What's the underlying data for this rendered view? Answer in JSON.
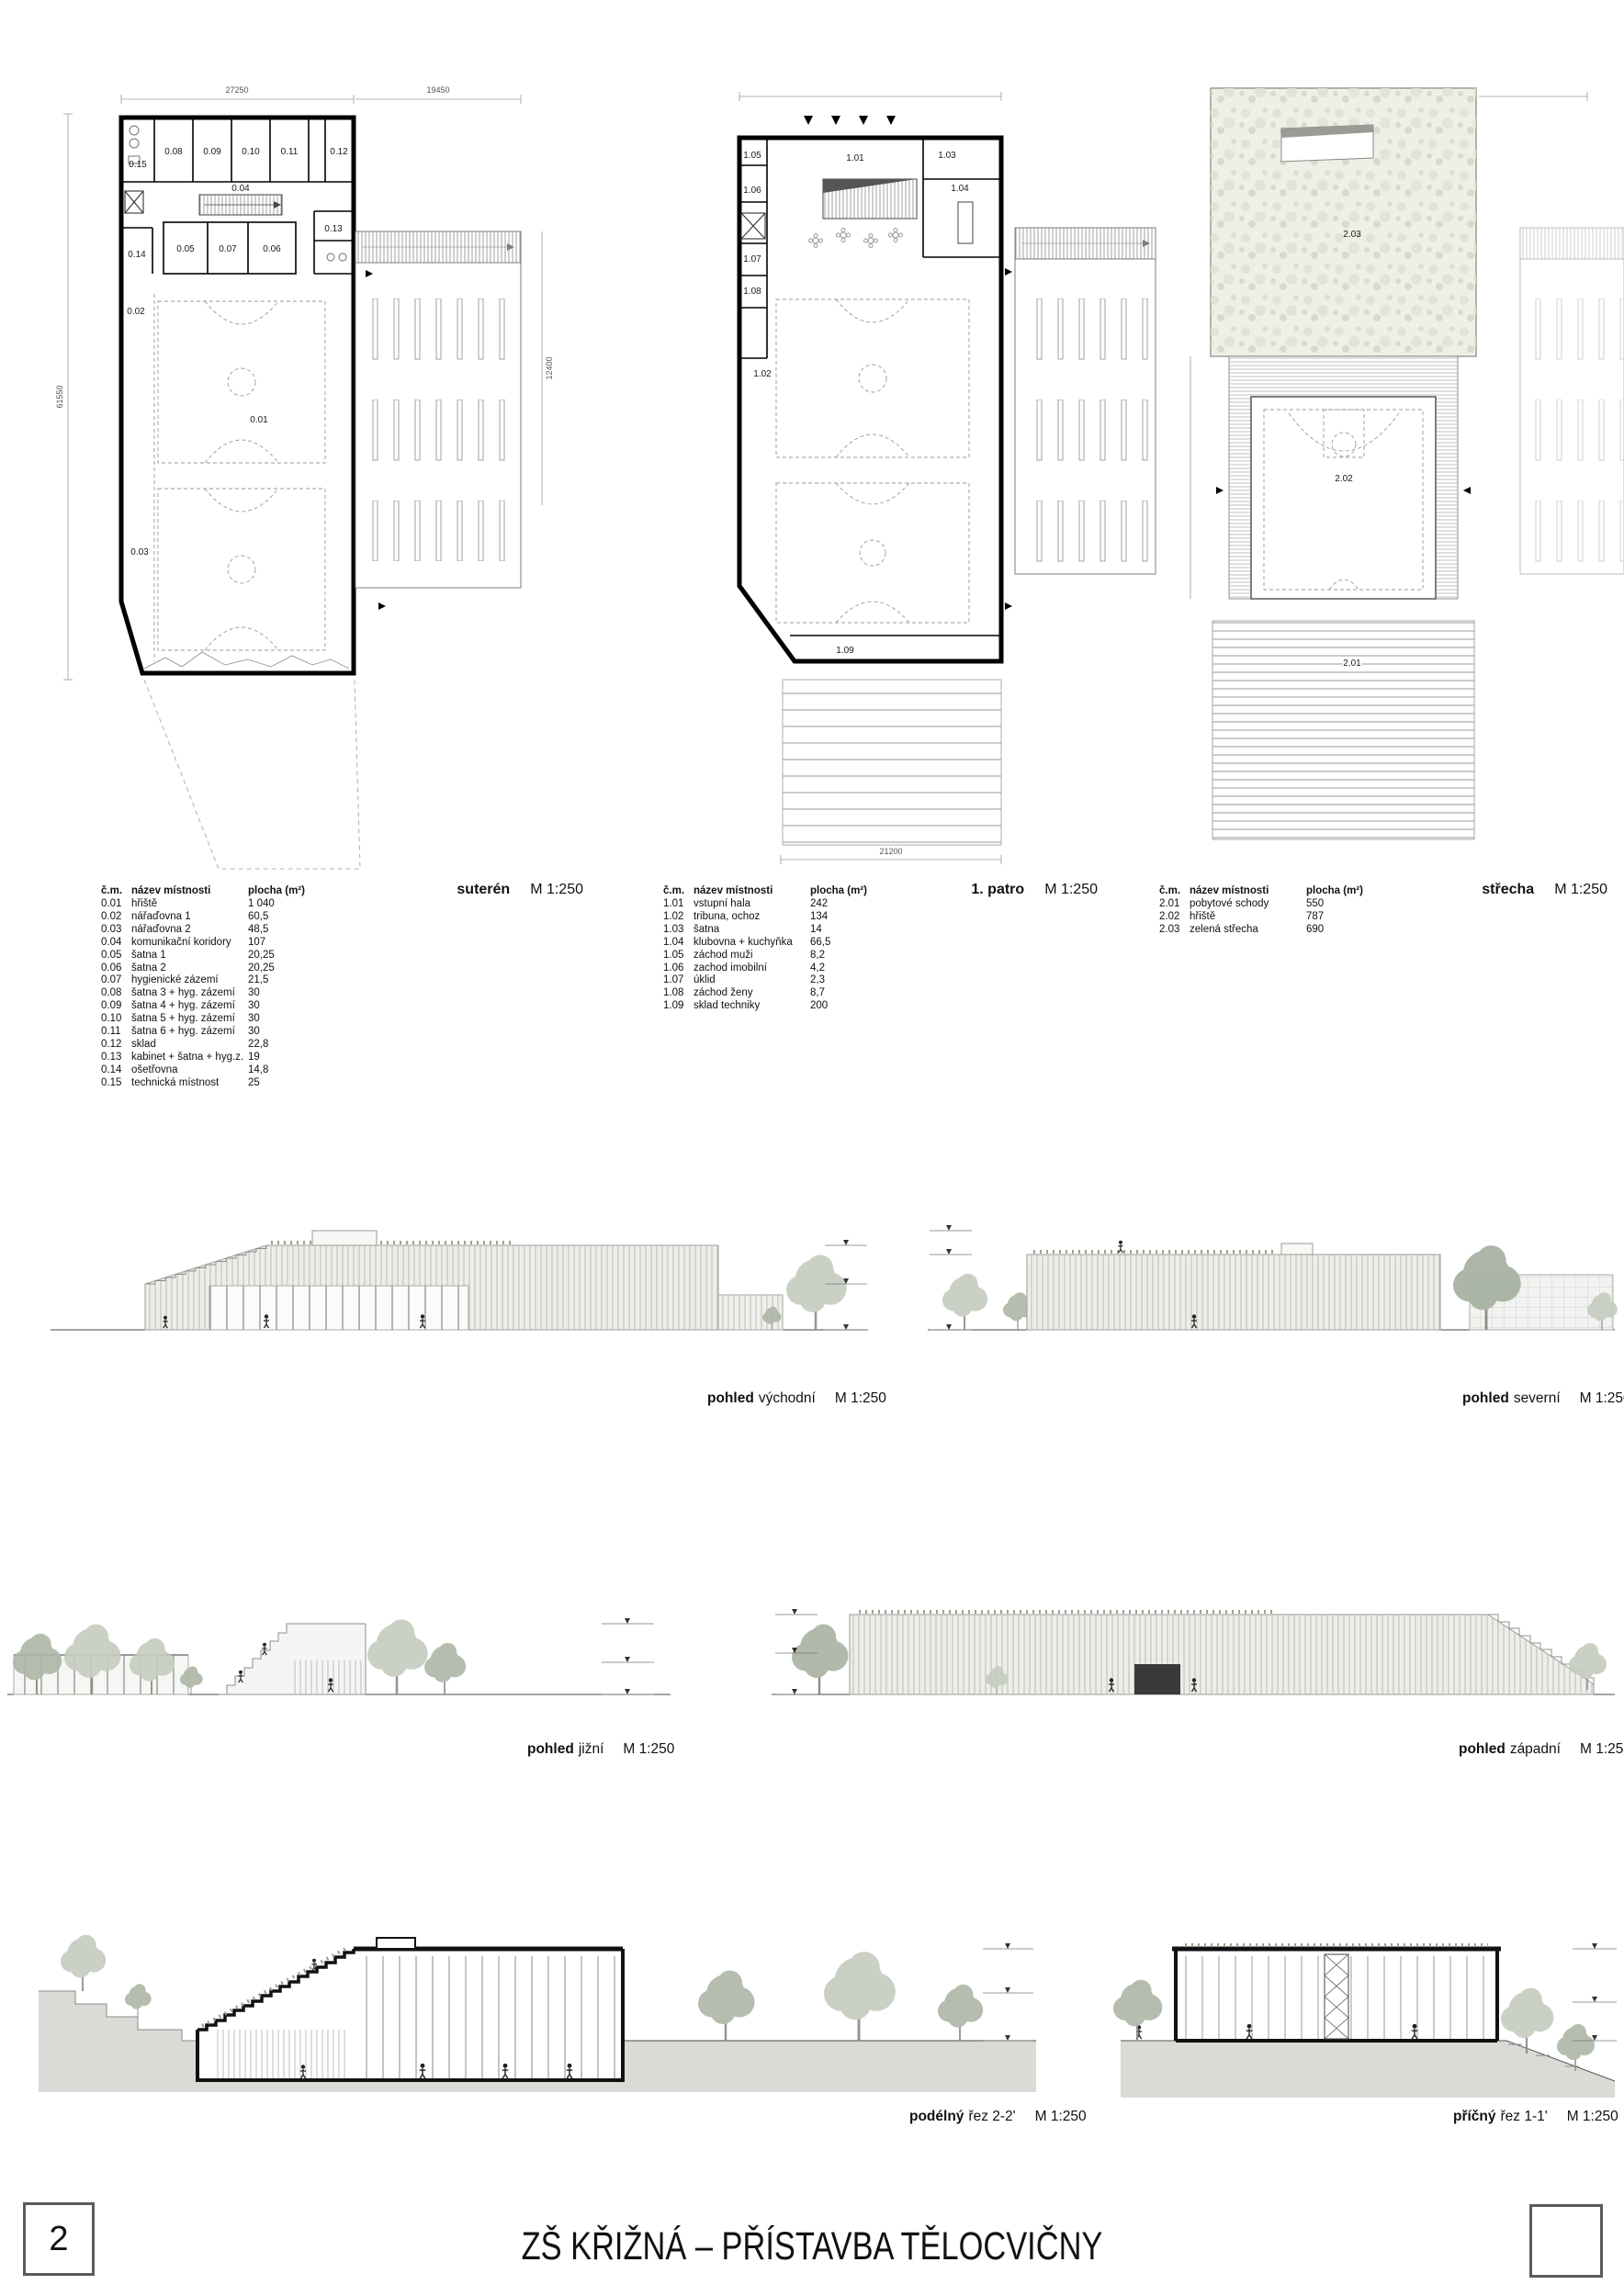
{
  "sheet": {
    "page_number": "2",
    "title": "ZŠ KŘIŽNÁ – PŘÍSTAVBA TĚLOCVIČNY"
  },
  "legend_columns": [
    "č.m.",
    "název místnosti",
    "plocha (m²)"
  ],
  "plans": {
    "suteren": {
      "caption": "suterén",
      "scale": "M 1:250",
      "dims": {
        "top_left": "27250",
        "top_right": "19450",
        "left": "61550",
        "right": "12400"
      },
      "rooms": [
        "0.15",
        "0.08",
        "0.09",
        "0.10",
        "0.11",
        "0.12",
        "0.04",
        "0.05",
        "0.07",
        "0.06",
        "0.13",
        "0.14",
        "0.02",
        "0.01",
        "0.03"
      ]
    },
    "patro": {
      "caption": "1. patro",
      "scale": "M 1:250",
      "dims": {
        "bottom": "21200"
      },
      "rooms": [
        "1.05",
        "1.06",
        "1.07",
        "1.08",
        "1.01",
        "1.03",
        "1.04",
        "1.02",
        "1.09"
      ]
    },
    "strecha": {
      "caption": "střecha",
      "scale": "M 1:250",
      "rooms": [
        "2.03",
        "2.02",
        "2.01"
      ]
    }
  },
  "legends": {
    "suteren": {
      "rows": [
        [
          "0.01",
          "hřiště",
          "1 040"
        ],
        [
          "0.02",
          "nářaďovna 1",
          "60,5"
        ],
        [
          "0.03",
          "nářaďovna 2",
          "48,5"
        ],
        [
          "0.04",
          "komunikační koridory",
          "107"
        ],
        [
          "0.05",
          "šatna 1",
          "20,25"
        ],
        [
          "0.06",
          "šatna 2",
          "20,25"
        ],
        [
          "0.07",
          "hygienické zázemí",
          "21,5"
        ],
        [
          "0.08",
          "šatna 3 + hyg. zázemí",
          "30"
        ],
        [
          "0.09",
          "šatna 4 + hyg. zázemí",
          "30"
        ],
        [
          "0.10",
          "šatna 5 + hyg. zázemí",
          "30"
        ],
        [
          "0.11",
          "šatna 6 + hyg. zázemí",
          "30"
        ],
        [
          "0.12",
          "sklad",
          "22,8"
        ],
        [
          "0.13",
          "kabinet + šatna + hyg.z.",
          "19"
        ],
        [
          "0.14",
          "ošetřovna",
          "14,8"
        ],
        [
          "0.15",
          "technická místnost",
          "25"
        ]
      ]
    },
    "patro": {
      "rows": [
        [
          "1.01",
          "vstupní hala",
          "242"
        ],
        [
          "1.02",
          "tribuna, ochoz",
          "134"
        ],
        [
          "1.03",
          "šatna",
          "14"
        ],
        [
          "1.04",
          "klubovna + kuchyňka",
          "66,5"
        ],
        [
          "1.05",
          "záchod muži",
          "8,2"
        ],
        [
          "1.06",
          "zachod imobilní",
          "4,2"
        ],
        [
          "1.07",
          "úklid",
          "2,3"
        ],
        [
          "1.08",
          "záchod ženy",
          "8,7"
        ],
        [
          "1.09",
          "sklad techniky",
          "200"
        ]
      ]
    },
    "strecha": {
      "rows": [
        [
          "2.01",
          "pobytové schody",
          "550"
        ],
        [
          "2.02",
          "hřiště",
          "787"
        ],
        [
          "2.03",
          "zelená střecha",
          "690"
        ]
      ]
    }
  },
  "views": {
    "east": {
      "name_bold": "pohled",
      "name": "východní",
      "scale": "M 1:250"
    },
    "north": {
      "name_bold": "pohled",
      "name": "severní",
      "scale": "M 1:250"
    },
    "south": {
      "name_bold": "pohled",
      "name": "jižní",
      "scale": "M 1:250"
    },
    "west": {
      "name_bold": "pohled",
      "name": "západní",
      "scale": "M 1:250"
    },
    "long_section": {
      "name_bold": "podélný",
      "name": "řez 2-2'",
      "scale": "M 1:250"
    },
    "cross_section": {
      "name_bold": "příčný",
      "name": "řez 1-1'",
      "scale": "M 1:250"
    }
  }
}
